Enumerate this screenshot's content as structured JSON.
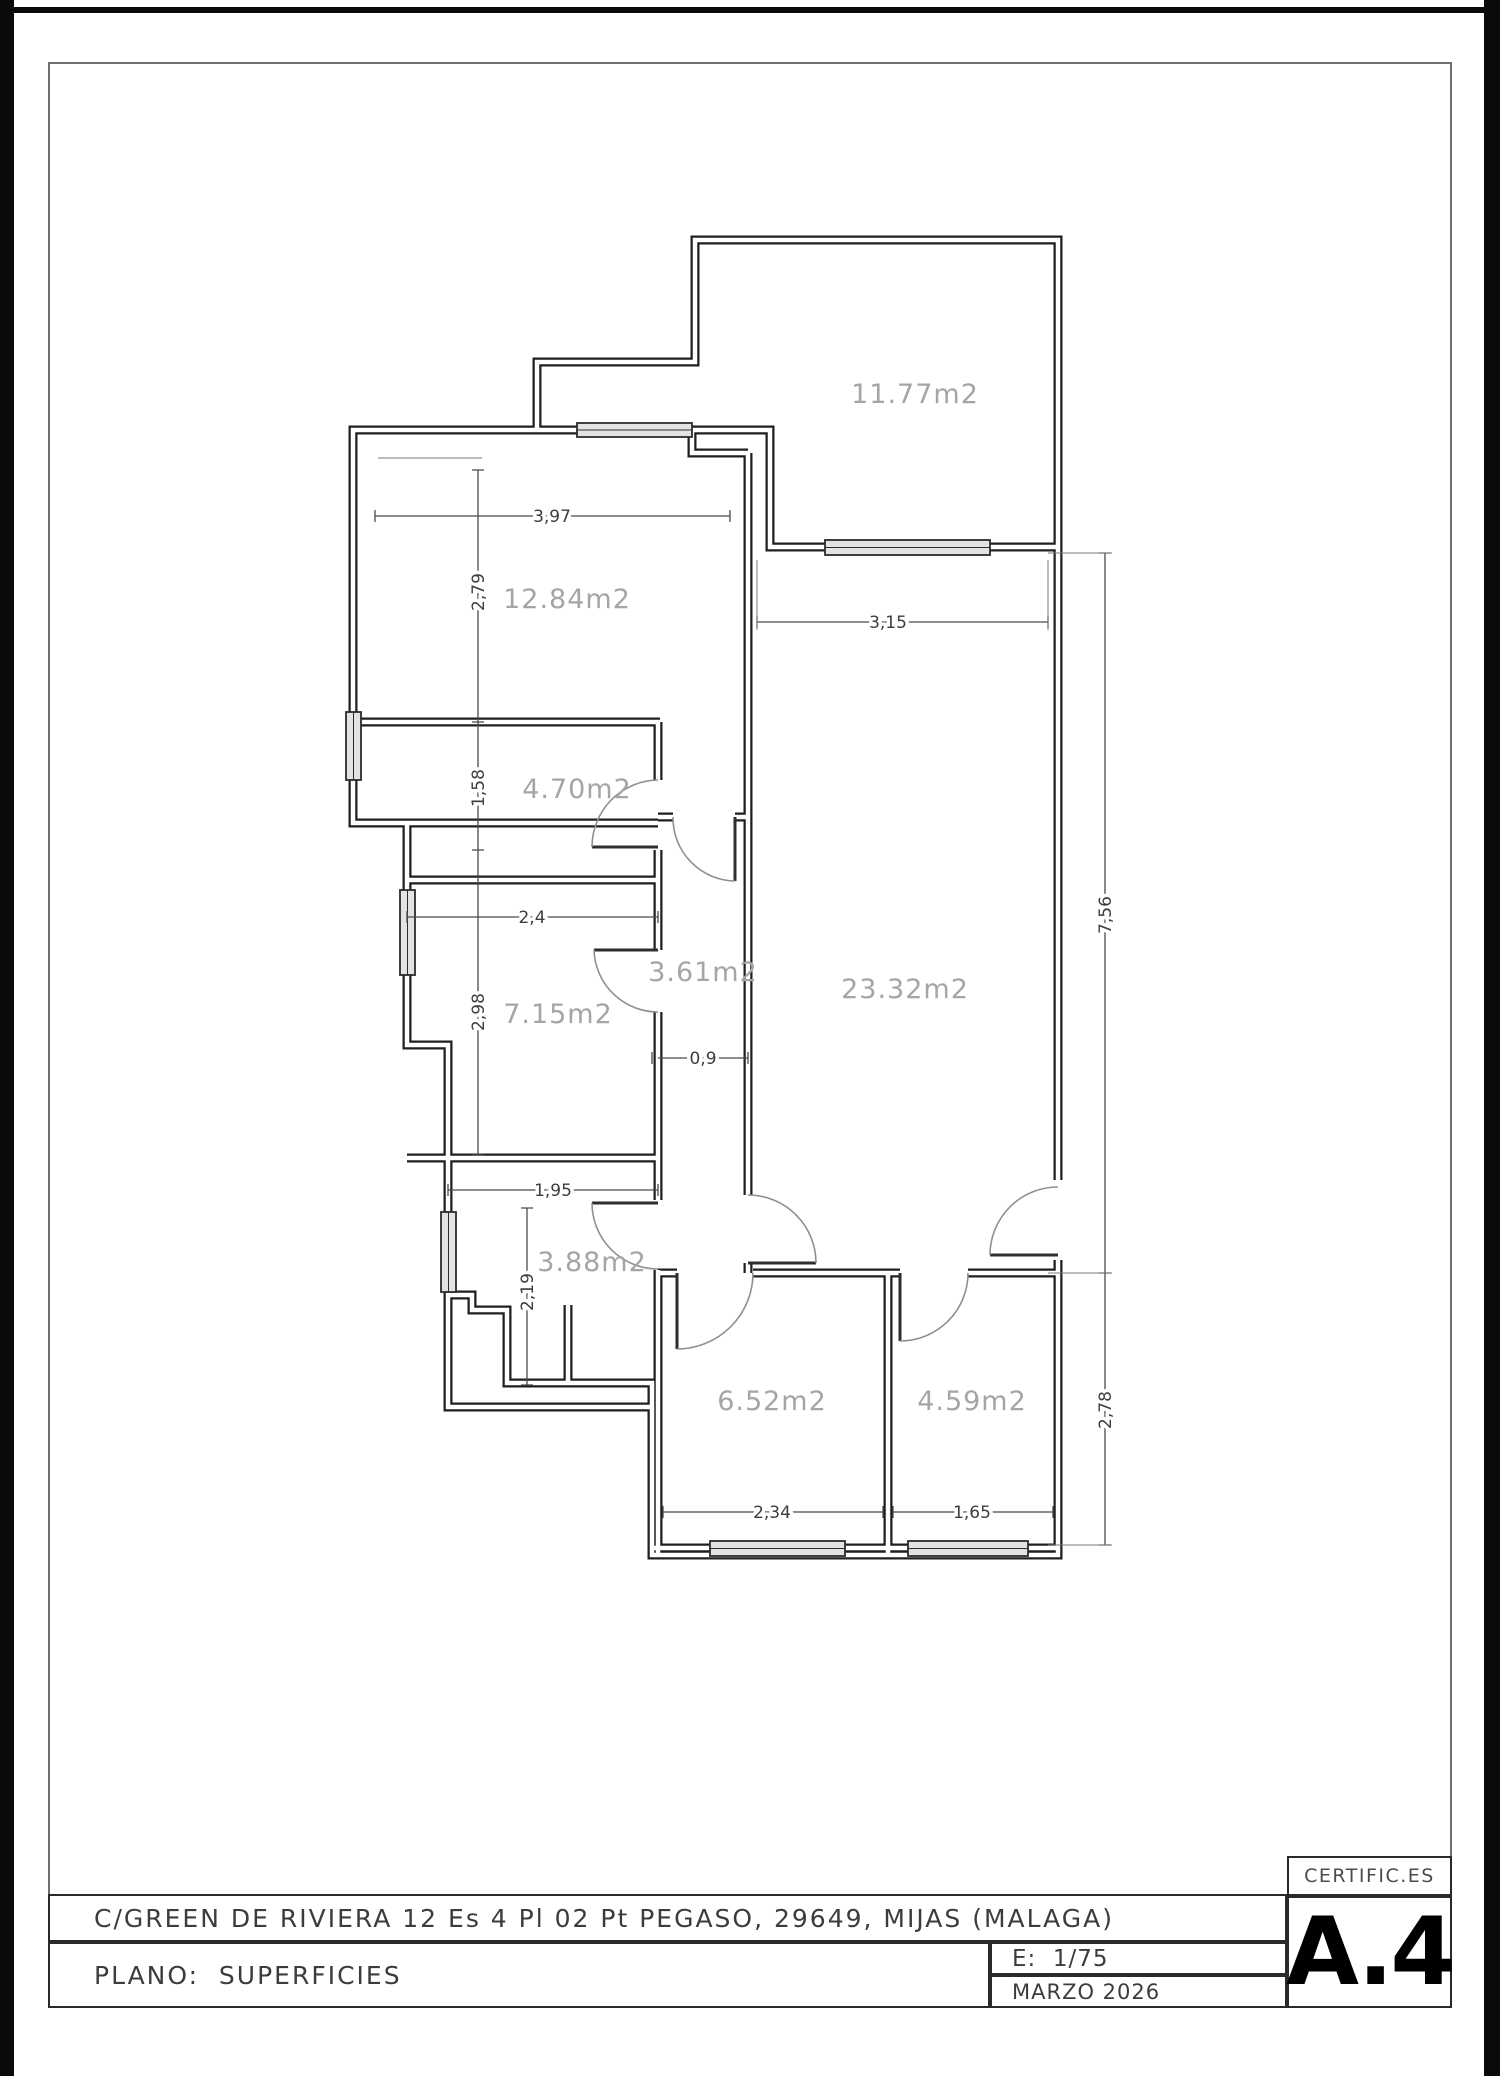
{
  "sheet": {
    "brand": "CERTIFIC.ES",
    "address": "C/GREEN DE RIVIERA 12 Es 4 Pl 02 Pt PEGASO, 29649, MIJAS (MALAGA)",
    "plan_title": "PLANO:  SUPERFICIES",
    "scale": "E:  1/75",
    "date": "MARZO 2026",
    "sheet_code": "A.4"
  },
  "plan": {
    "type": "floor_plan",
    "rooms": [
      {
        "id": "top-terrace",
        "area": "11.77m2"
      },
      {
        "id": "top-left",
        "area": "12.84m2"
      },
      {
        "id": "mid-left-small",
        "area": "4.70m2"
      },
      {
        "id": "hall",
        "area": "3.61m2"
      },
      {
        "id": "mid-left",
        "area": "7.15m2"
      },
      {
        "id": "main-right",
        "area": "23.32m2"
      },
      {
        "id": "bottom-left",
        "area": "3.88m2"
      },
      {
        "id": "bottom-center",
        "area": "6.52m2"
      },
      {
        "id": "bottom-right",
        "area": "4.59m2"
      }
    ],
    "dimensions": [
      {
        "id": "top-left-width",
        "value": "3,97"
      },
      {
        "id": "top-left-height",
        "value": "2,79"
      },
      {
        "id": "mid-left-small-height",
        "value": "1,58"
      },
      {
        "id": "mid-left-width",
        "value": "2,4"
      },
      {
        "id": "mid-left-height",
        "value": "2,98"
      },
      {
        "id": "hall-width",
        "value": "0,9"
      },
      {
        "id": "main-right-width",
        "value": "3,15"
      },
      {
        "id": "main-right-height",
        "value": "7,56"
      },
      {
        "id": "bottom-left-width",
        "value": "1,95"
      },
      {
        "id": "bottom-left-height",
        "value": "2,19"
      },
      {
        "id": "bottom-right-height",
        "value": "2,78"
      },
      {
        "id": "bottom-center-width",
        "value": "2,34"
      },
      {
        "id": "bottom-right-width",
        "value": "1,65"
      }
    ],
    "colors": {
      "wall": "#1f1f1f",
      "room_label": "#a5a5a5",
      "dimension_text": "#3d3d3d",
      "window_fill": "#e3e3e3",
      "door_arc": "#909090"
    }
  }
}
